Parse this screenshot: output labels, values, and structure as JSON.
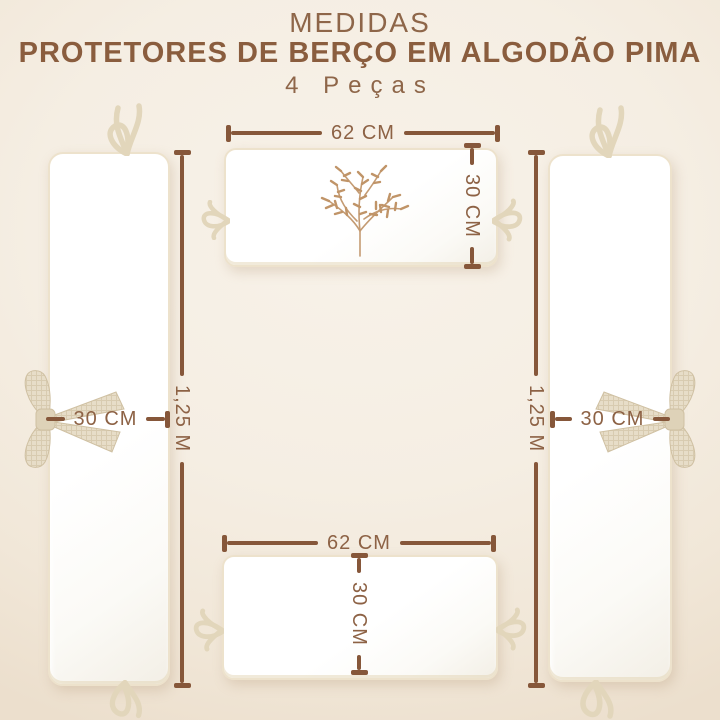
{
  "title": {
    "line1": "MEDIDAS",
    "line2": "PROTETORES DE BERÇO EM ALGODÃO PIMA",
    "line3": "4 Peças"
  },
  "measurements": {
    "top_piece": {
      "width": "62 CM",
      "height": "30 CM"
    },
    "bottom_piece": {
      "width": "62 CM",
      "height": "30 CM"
    },
    "left_piece": {
      "length": "1,25 M",
      "width": "30 CM"
    },
    "right_piece": {
      "length": "1,25 M",
      "width": "30 CM"
    }
  },
  "colors": {
    "accent_brown_text": "#8d6245",
    "accent_brown_line": "#86573a",
    "background_cream": "#f5eee3",
    "piece_white": "#ffffff",
    "piping_beige": "#ede2cc",
    "bow_fabric": "#e6dcc7",
    "embroidery_tan": "#c49b73"
  },
  "icons": {
    "embroidery": "botanical-sprig",
    "bows": "fabric-bow",
    "ties": "ribbon-tie"
  }
}
